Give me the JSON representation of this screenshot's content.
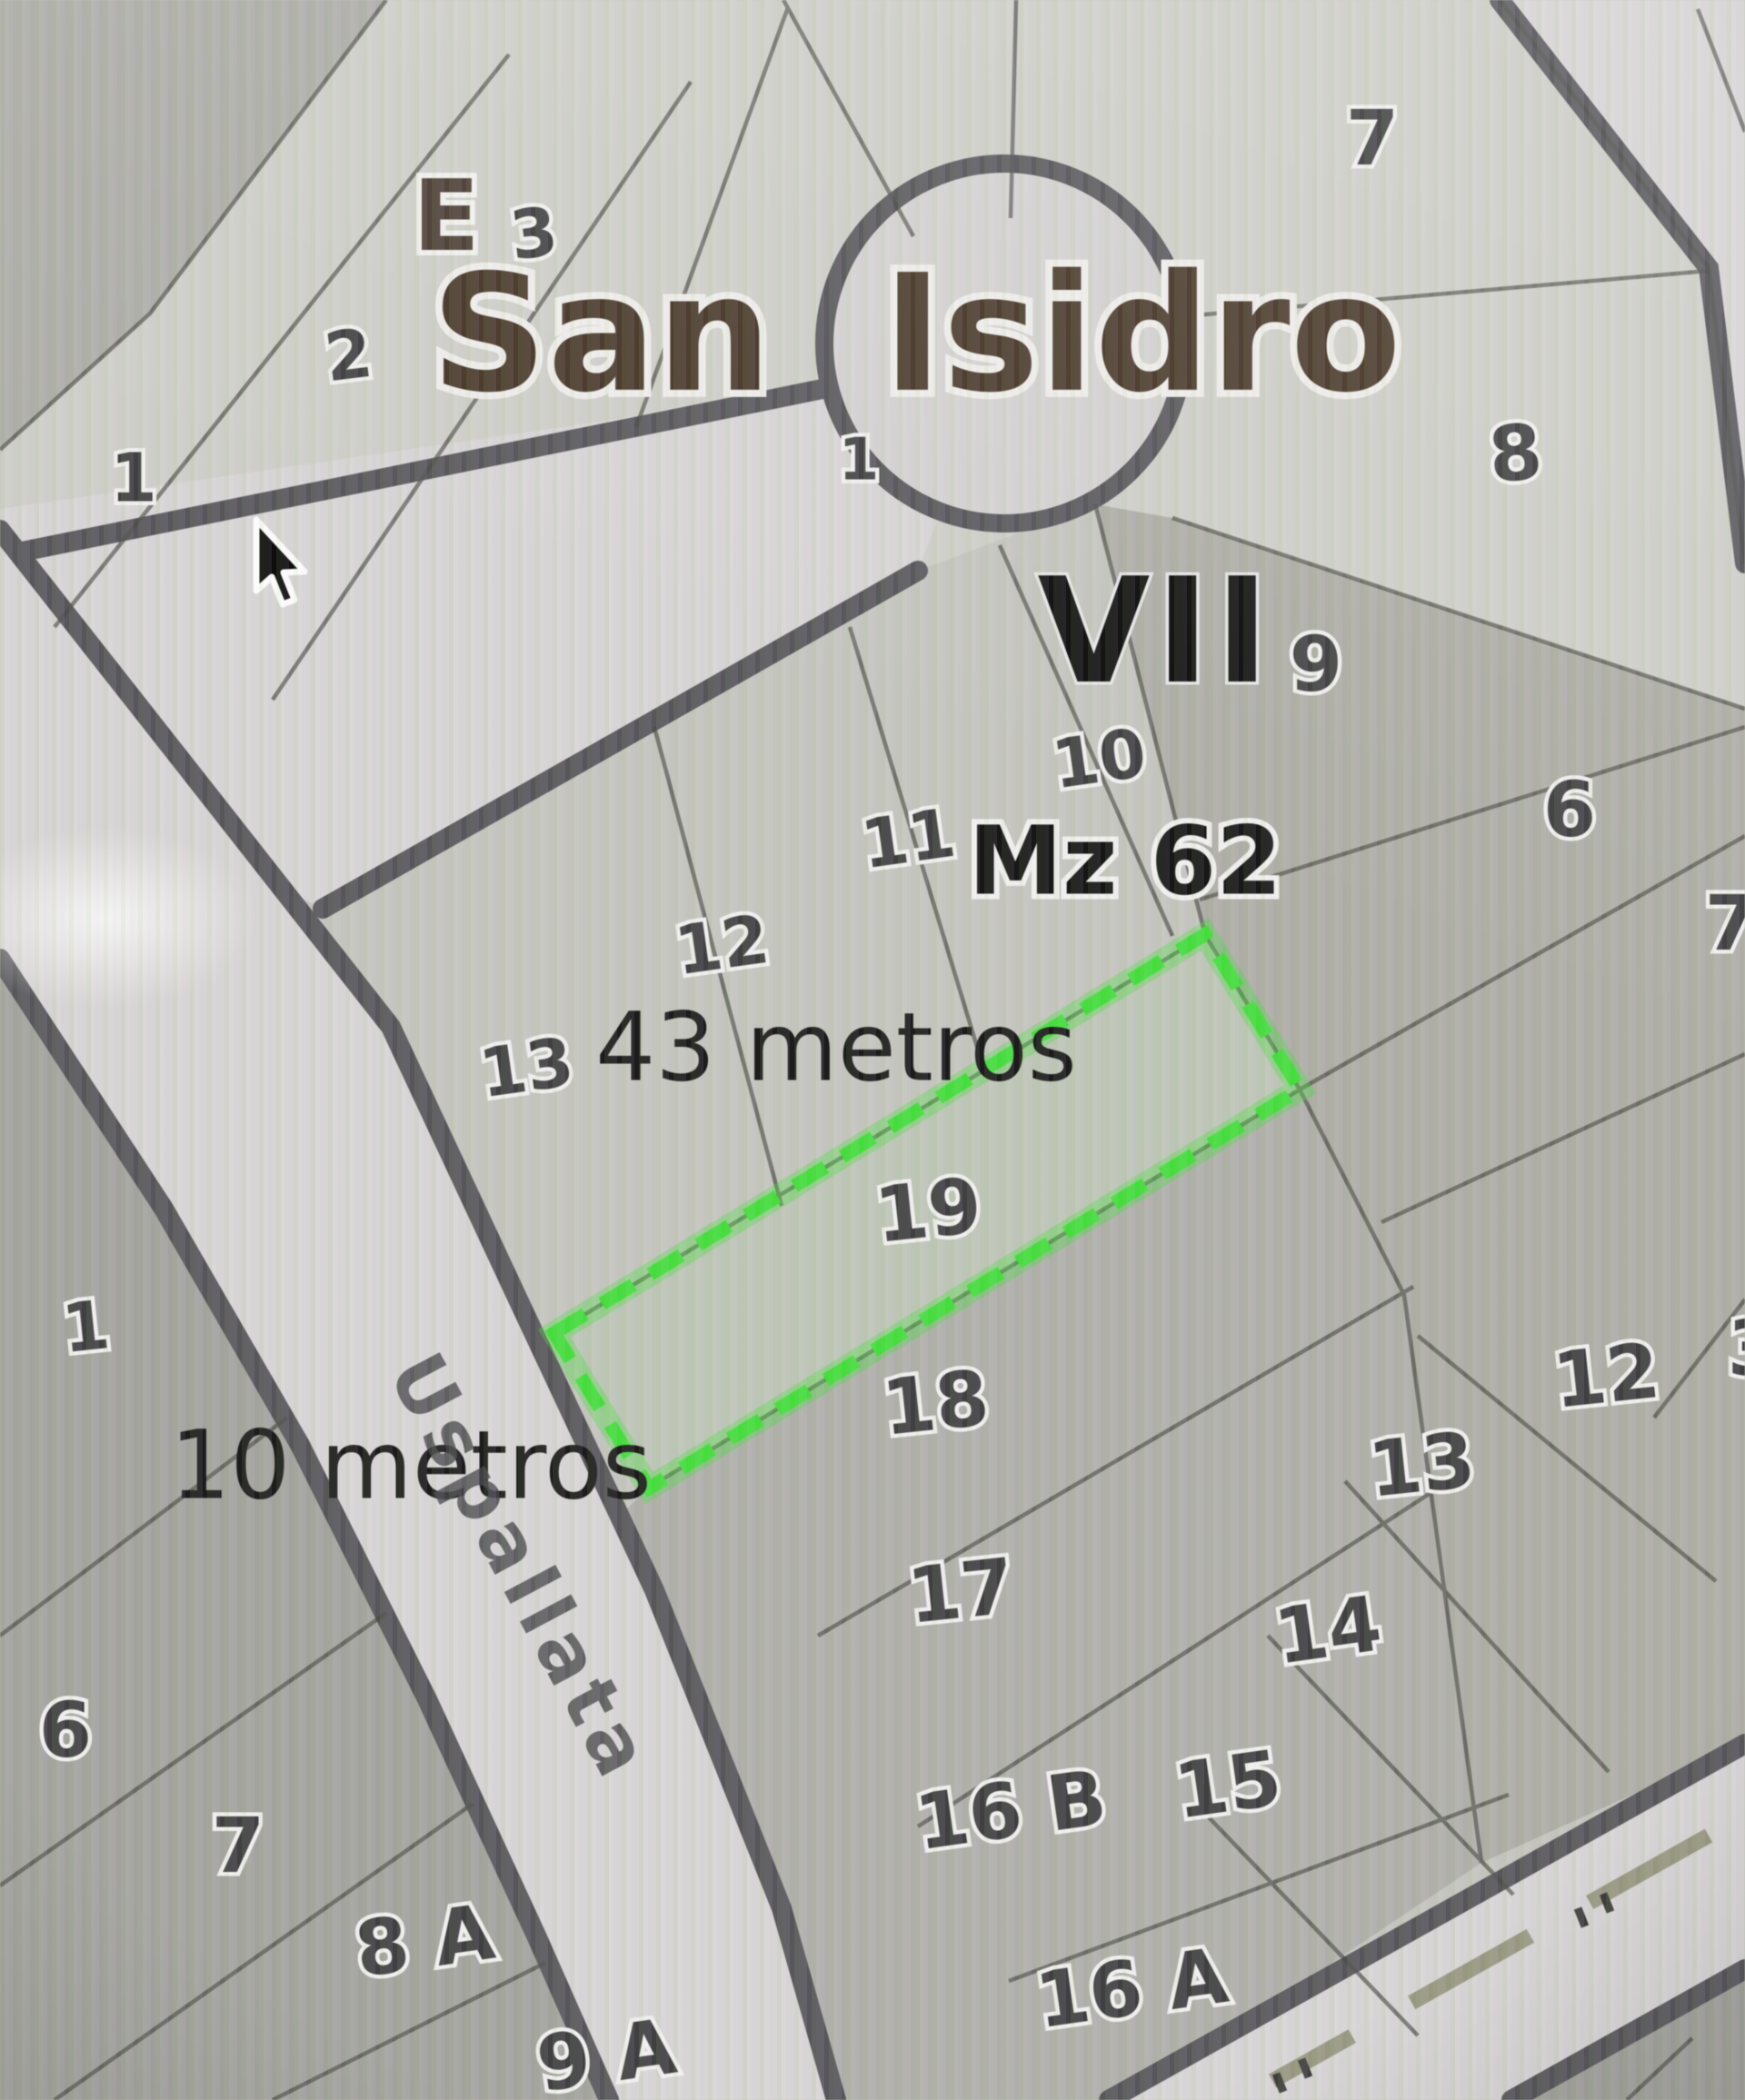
{
  "map": {
    "title": "San Isidro",
    "sector_label_left": "E",
    "sector_label_right": "VII",
    "manzana_label": "Mz 62",
    "street_name": "Uspallata",
    "annotations": {
      "depth": "43 metros",
      "frontage": "10 metros"
    },
    "highlight": {
      "lot": "19",
      "color": "#35e52c",
      "shape": "rotated-dashed-rectangle"
    },
    "colors": {
      "road_fill": "#d9d7d6",
      "road_edge": "#56555a",
      "block": "#c6c6bf",
      "lot_line": "#4a4a44",
      "title_brown": "#483626",
      "label_gray": "#3e3e40",
      "highlight_green": "#35e52c",
      "center_dash_olive": "#8f8f72"
    },
    "blocks": [
      {
        "sector": "E",
        "lots": [
          "1",
          "2",
          "3"
        ]
      },
      {
        "name": "cul-de-sac",
        "lots": [
          "1",
          "7",
          "8",
          "9"
        ]
      },
      {
        "manzana": "Mz 62",
        "sector": "VII",
        "lots": [
          "10",
          "11",
          "12",
          "13",
          "19",
          "18",
          "17",
          "16 B",
          "16 A"
        ]
      },
      {
        "name": "east-column",
        "lots": [
          "6",
          "7",
          "12",
          "3",
          "13",
          "14",
          "15"
        ]
      },
      {
        "name": "south-west",
        "lots": [
          "1",
          "6",
          "7",
          "8 A",
          "9 A"
        ]
      }
    ],
    "labels": [
      {
        "t": "1"
      },
      {
        "t": "2"
      },
      {
        "t": "3"
      },
      {
        "t": "1"
      },
      {
        "t": "7"
      },
      {
        "t": "8"
      },
      {
        "t": "9"
      },
      {
        "t": "10"
      },
      {
        "t": "11"
      },
      {
        "t": "12"
      },
      {
        "t": "13"
      },
      {
        "t": "6"
      },
      {
        "t": "7"
      },
      {
        "t": "19"
      },
      {
        "t": "18"
      },
      {
        "t": "12"
      },
      {
        "t": "3"
      },
      {
        "t": "13"
      },
      {
        "t": "1"
      },
      {
        "t": "17"
      },
      {
        "t": "14"
      },
      {
        "t": "6"
      },
      {
        "t": "15"
      },
      {
        "t": "16 B"
      },
      {
        "t": "7"
      },
      {
        "t": "8 A"
      },
      {
        "t": "16 A"
      },
      {
        "t": "9 A"
      }
    ]
  }
}
